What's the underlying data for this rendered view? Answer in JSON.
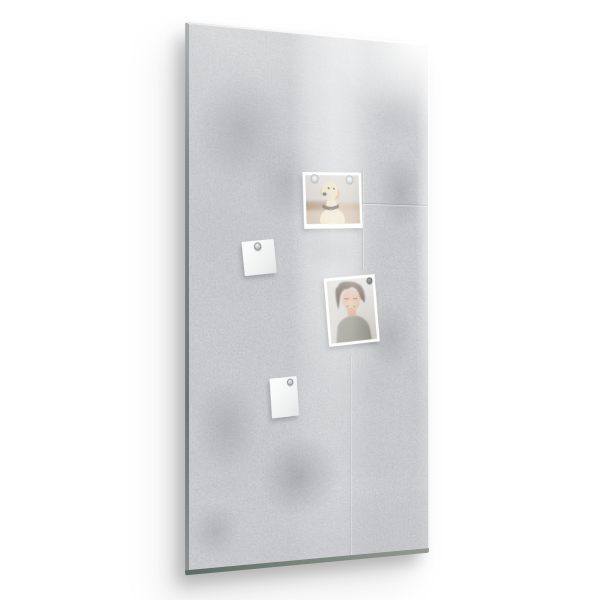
{
  "scene": {
    "kind": "product-photo",
    "subject": "Glass magnetic memo board with gray concrete texture on a white background",
    "visible_text": ""
  },
  "colors": {
    "wall": "#ffffff",
    "concrete_base": "#d8d9da",
    "concrete_shade": "#7d8084",
    "glass_edge_left_dark": "#6f7274",
    "glass_edge_left_light": "#aeb1b2",
    "glass_edge_bottom_dark": "#5f6a64",
    "glass_edge_bottom_light": "#939990",
    "photo_border": "#fdfdfc",
    "note_face": "#f9fafa",
    "note_shade": "#e3e5e5",
    "magnet_silver_light": "#eff1f1",
    "magnet_silver_dark": "#9fa4a6",
    "magnet_dark": "#707476",
    "dog_fur_light": "#ecdfc2",
    "dog_fur": "#e5d2a9",
    "dog_ear": "#c8a473",
    "dog_nose": "#3c3734",
    "dog_collar": "#44362a",
    "person_hair": "#4d3a2d",
    "person_skin": "#d9ad92",
    "person_sweater": "#8c8c81"
  },
  "board": {
    "items": [
      {
        "name": "dog-photo",
        "kind": "photo",
        "depicts": "yellow labrador dog snapshot",
        "magnets": 2
      },
      {
        "name": "note-upper",
        "kind": "note",
        "depicts": "small blank white square note",
        "magnets": 1
      },
      {
        "name": "person-photo",
        "kind": "photo",
        "depicts": "smiling person in gray sweater snapshot",
        "magnets": 1
      },
      {
        "name": "note-lower",
        "kind": "note",
        "depicts": "small blank white note",
        "magnets": 1
      }
    ],
    "magnet_total": 5
  }
}
